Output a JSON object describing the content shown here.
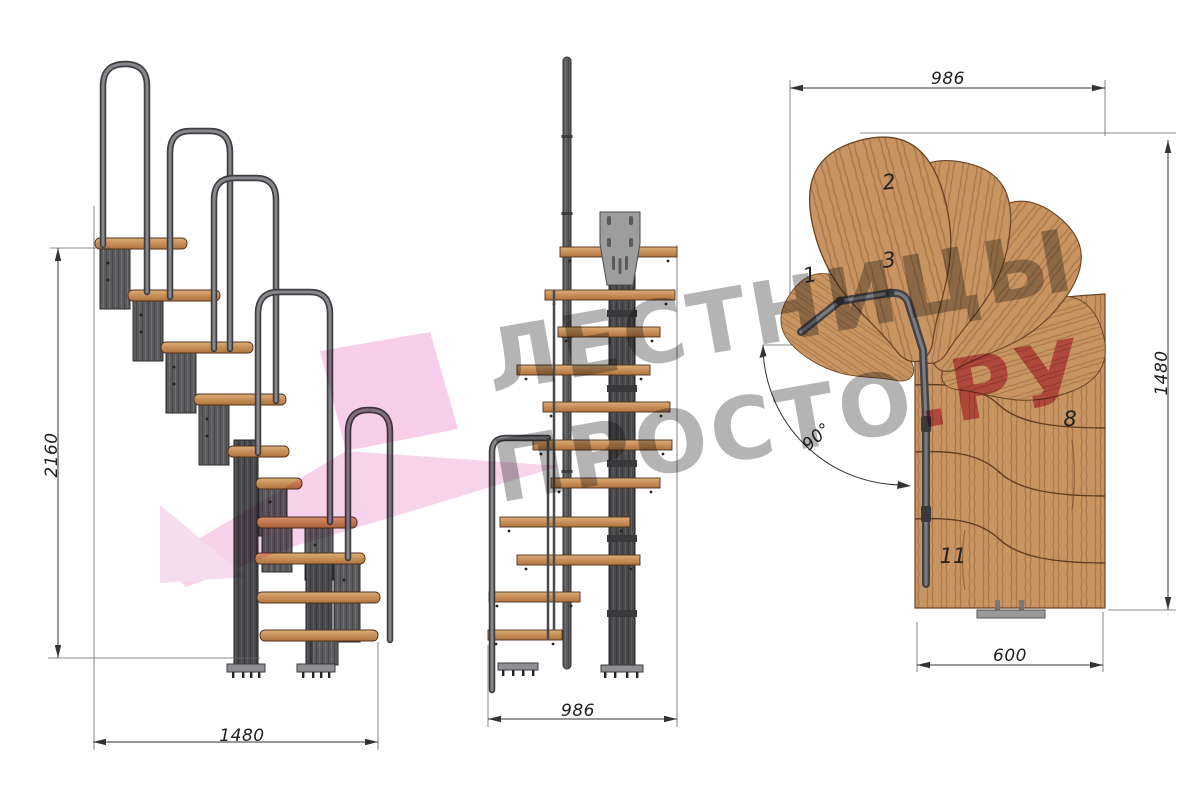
{
  "watermark": {
    "line1": "ЛЕСТНИЦЫ",
    "line2_main": "ПРОСТО",
    "line2_accent": ".РУ"
  },
  "dimensions": {
    "side_height": "2160",
    "side_width": "1480",
    "front_width": "986",
    "plan_top_width": "986",
    "plan_right_height": "1480",
    "plan_bottom_width": "600",
    "plan_turn_angle": "90°"
  },
  "plan_step_labels": [
    {
      "label": "1"
    },
    {
      "label": "2"
    },
    {
      "label": "3"
    },
    {
      "label": "8"
    },
    {
      "label": "11"
    }
  ],
  "colors": {
    "wood": "#c79462",
    "metal": "#5b5b5e",
    "watermark_gray": "#8e8e8e",
    "watermark_accent": "#ca2a55",
    "logo_pink": "#f2a7d8"
  }
}
